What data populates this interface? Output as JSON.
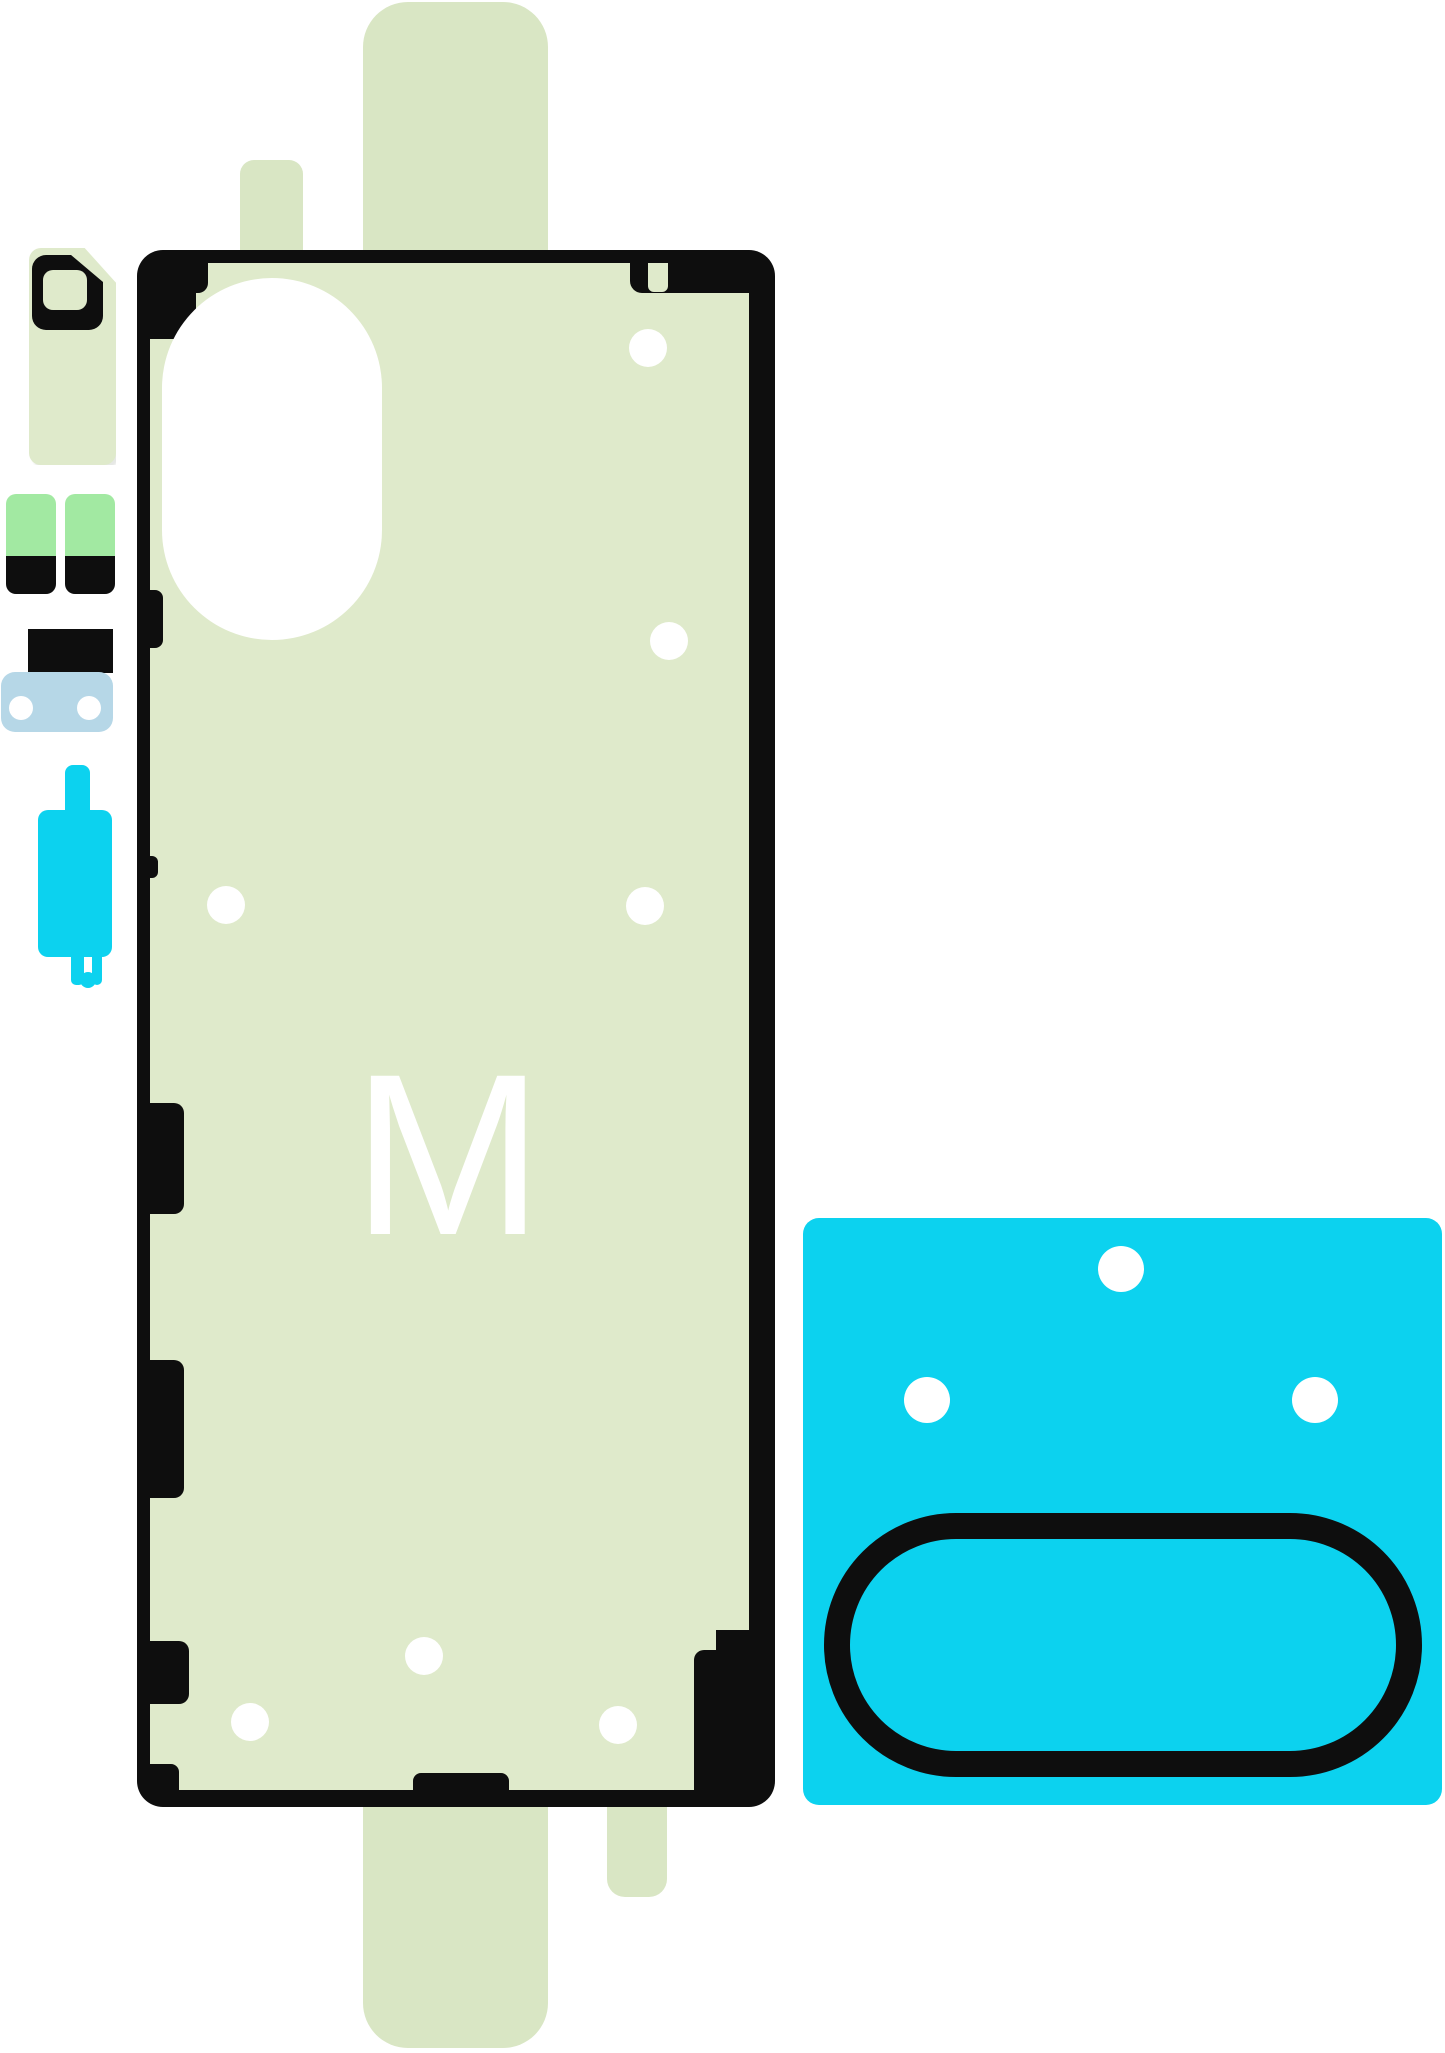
{
  "image_type": "parts-diagram",
  "subject": "Smartphone back cover adhesive sticker kit (rework tape set)",
  "panel": {
    "label": "M"
  },
  "colors": {
    "paleGreen": "#dfeacb",
    "stripGreen": "#d9e6c4",
    "tabGreen": "#a2e9a2",
    "cyan": "#0cd2ef",
    "lightBlue": "#b6d7e7",
    "black": "#0e0e0e",
    "white": "#ffffff"
  },
  "parts": [
    {
      "name": "back-cover-adhesive-sheet",
      "marking": "M",
      "holes": 7
    },
    {
      "name": "camera-oval-cutout"
    },
    {
      "name": "camera-surround-adhesive-sheet-cyan",
      "holes": 3,
      "window_outline": "rounded-stadium"
    },
    {
      "name": "camera-ring-sticker",
      "shape": "D-ring"
    },
    {
      "name": "adhesive-pull-tab-left",
      "colors": [
        "tabGreen",
        "black"
      ]
    },
    {
      "name": "adhesive-pull-tab-right",
      "colors": [
        "tabGreen",
        "black"
      ]
    },
    {
      "name": "spacer-bar-sticker"
    },
    {
      "name": "flash-bracket-sticker-lightblue",
      "holes": 2
    },
    {
      "name": "button-bracket-sticker-cyan"
    },
    {
      "name": "release-liner-strips",
      "count": 3
    }
  ]
}
